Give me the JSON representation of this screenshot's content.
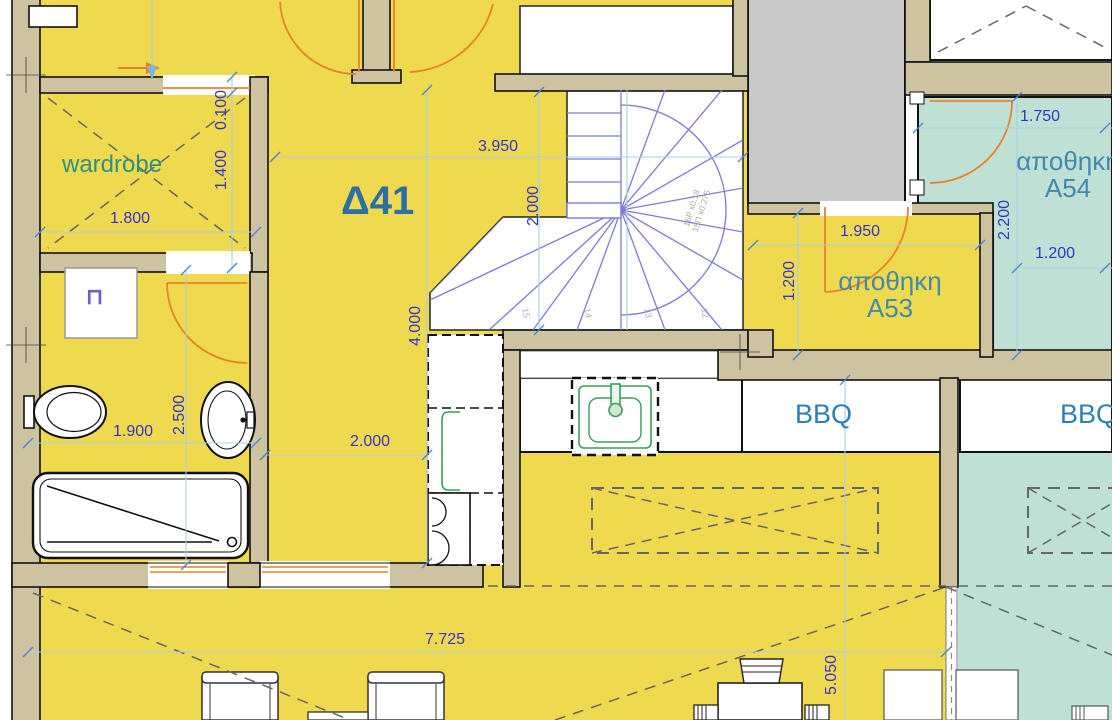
{
  "unit": {
    "label": "Δ41"
  },
  "rooms": {
    "wardrobe": "wardrobe",
    "storage_a53_line1": "αποθηκη",
    "storage_a53_line2": "A53",
    "storage_a54_line1": "αποθηκη",
    "storage_a54_line2": "A54",
    "bbq_left": "BBQ",
    "bbq_right": "BBQ"
  },
  "dimensions": {
    "wardrobe_width": "1.800",
    "wardrobe_depth": "1.400",
    "wall_offset": "0.100",
    "hall_width": "3.950",
    "stair_width": "2.000",
    "hall_length": "4.000",
    "hall_lower_width": "2.000",
    "bath_width": "1.900",
    "bath_length": "2.500",
    "a54_door_width": "1.750",
    "a54_depth": "2.200",
    "a54_lower_width": "1.200",
    "a53_width": "1.950",
    "a53_depth": "1.200",
    "terrace_width": "7.725",
    "terrace_depth": "5.050"
  },
  "stairs": {
    "note_line1": "16P x0.18",
    "note_line2": "15Π x0.275",
    "n12": "12",
    "n13": "13",
    "n14": "14",
    "n15": "15"
  },
  "fixtures": {
    "washer_symbol": "⊓"
  },
  "colors": {
    "floor_yellow": "#EFD94F",
    "terrace_teal": "#BFE0D5",
    "wall_tan": "#CDC3A0",
    "shaft_gray": "#C9C9C9",
    "dim_blue": "#3434C8",
    "label_teal": "#2F9080",
    "label_blue": "#2B6FA6",
    "storage_label_blue": "#4289AC",
    "stair_purple": "#7B7BD8",
    "door_orange": "#E8822A"
  }
}
